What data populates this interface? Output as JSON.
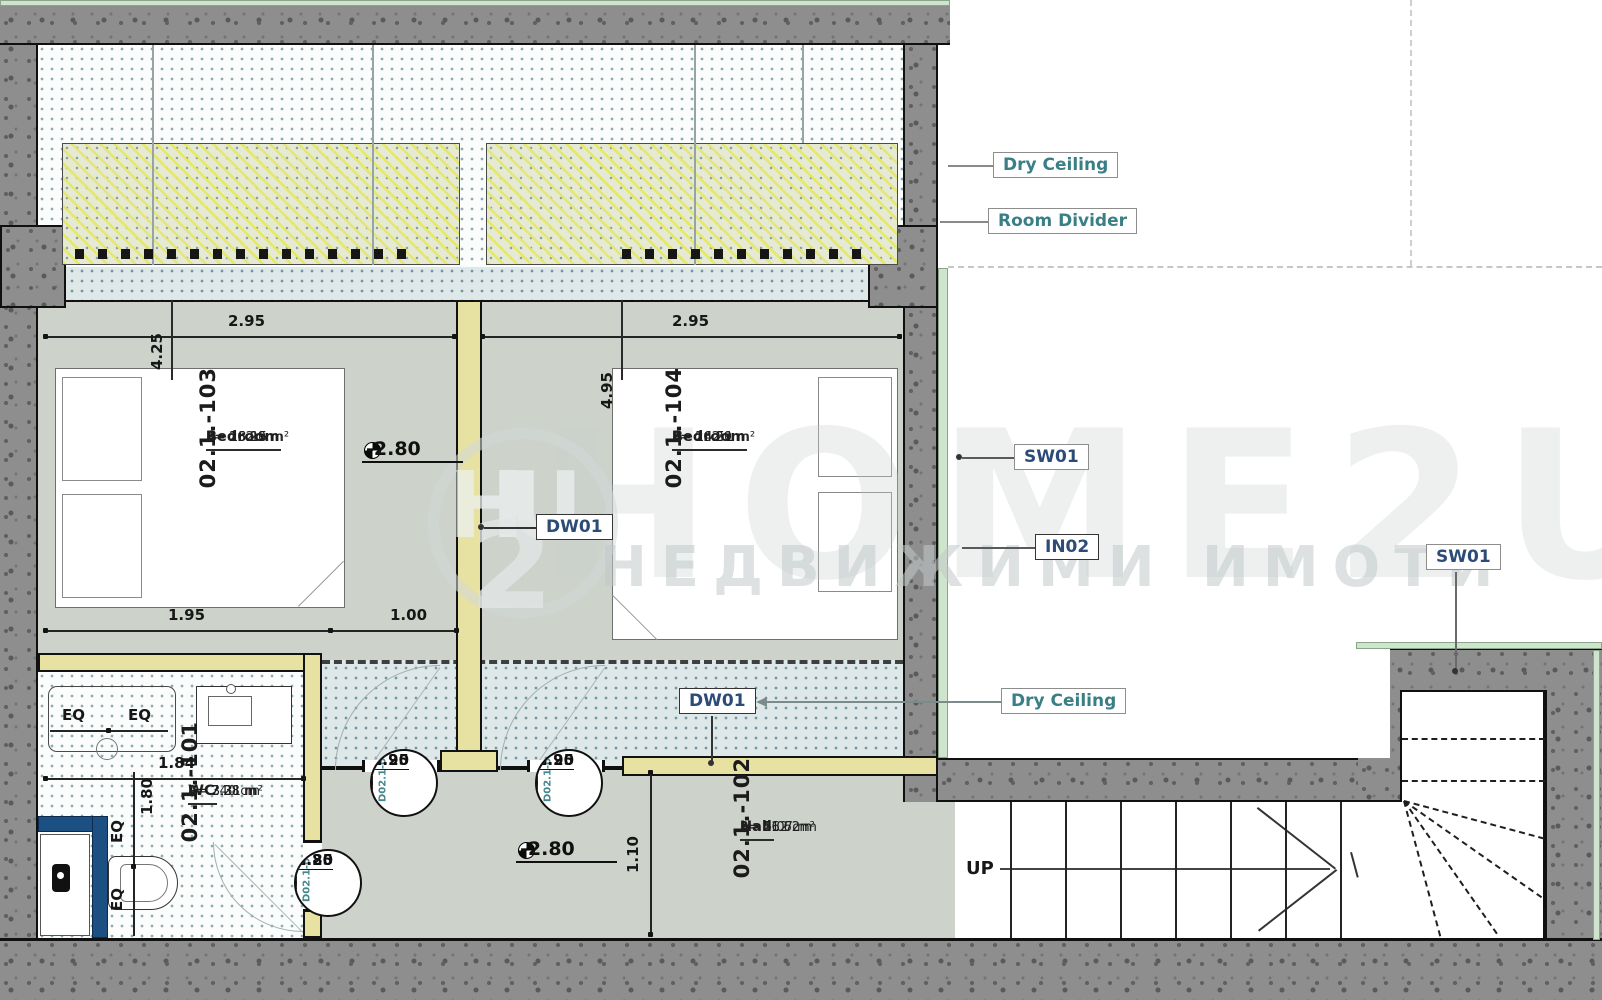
{
  "plan": {
    "rooms": [
      {
        "id": "02.1.-103",
        "name": "Bedroom",
        "area": "A= 13.15 m²",
        "perimeter": "P= 16.29 m",
        "height": "h= 262 cm"
      },
      {
        "id": "02.1.-104",
        "name": "Bedroom",
        "area": "A= 14.51 m²",
        "perimeter": "P= 16.29 m",
        "height": "h= 262 cm"
      },
      {
        "id": "02.1.-101",
        "name": "WC",
        "area": "A= 3.31 m²",
        "perimeter": "P= 7.28 m",
        "height": "h= 240 cm"
      },
      {
        "id": "02.1.-102",
        "name": "Hall",
        "area": "A= 5.07 m²",
        "perimeter": "P= 11.62 m",
        "height": "h= 262 cm"
      }
    ],
    "doors": [
      {
        "id": "D02.1-01",
        "width": "0.80",
        "height": "2.25"
      },
      {
        "id": "D02.1-02",
        "width": "0.90",
        "height": "2.25"
      },
      {
        "id": "D02.1-03",
        "width": "0.90",
        "height": "2.25"
      }
    ],
    "annotations": {
      "dry_ceiling_top": "Dry Ceiling",
      "dry_ceiling_bottom": "Dry Ceiling",
      "room_divider": "Room Divider",
      "sw01_left": "SW01",
      "sw01_right": "SW01",
      "in02": "IN02",
      "dw01_upper": "DW01",
      "dw01_lower": "DW01",
      "up": "UP"
    },
    "dimensions": {
      "bed1_width": "2.95",
      "bed1_depth": "4.25",
      "bed2_width": "2.95",
      "bed2_depth": "4.95",
      "bed1_seg_left": "1.95",
      "bed1_seg_right": "1.00",
      "wc_width": "1.84",
      "wc_depth": "1.80",
      "hall_width": "1.10",
      "eq": "EQ"
    },
    "elevations": {
      "bedroom1": "-2.80",
      "hall": "-2.80"
    },
    "watermark": {
      "logo_h": "H",
      "logo_u": "U",
      "logo_2": "2",
      "brand": "HOME2U",
      "subtitle": "НЕДВИЖИМИ ИМОТИ"
    },
    "colors": {
      "teal_label": "#3a7f86",
      "navy_label": "#2d4b77",
      "wood_wall": "#e8e2a2",
      "floor": "#cdd3cb",
      "concrete": "#8e8e8e",
      "insulation": "#cfe4cd",
      "shower_wall": "#1c4f82"
    }
  }
}
